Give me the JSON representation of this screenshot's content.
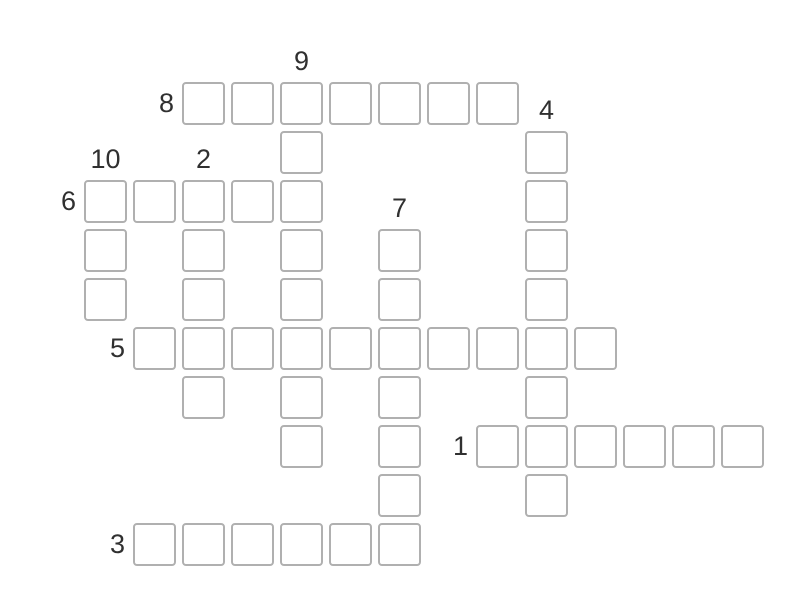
{
  "page": {
    "background_color": "#ffffff",
    "title": "crossword-puzzle"
  },
  "crossword": {
    "grid": {
      "origin_x": 84,
      "origin_y": 82,
      "pitch": 49
    },
    "cell": {
      "size": 43,
      "border_color": "#b0b0b0",
      "border_width": 2,
      "corner_radius": 4,
      "fill_color": "#ffffff"
    },
    "label": {
      "color": "#303030",
      "font_size": 27
    },
    "words": [
      {
        "number": 1,
        "direction": "across",
        "row": 7,
        "col": 8,
        "length": 6
      },
      {
        "number": 2,
        "direction": "down",
        "row": 2,
        "col": 2,
        "length": 5
      },
      {
        "number": 3,
        "direction": "across",
        "row": 9,
        "col": 1,
        "length": 6
      },
      {
        "number": 4,
        "direction": "down",
        "row": 1,
        "col": 9,
        "length": 8
      },
      {
        "number": 5,
        "direction": "across",
        "row": 5,
        "col": 1,
        "length": 10
      },
      {
        "number": 6,
        "direction": "across",
        "row": 2,
        "col": 0,
        "length": 5
      },
      {
        "number": 7,
        "direction": "down",
        "row": 3,
        "col": 6,
        "length": 7
      },
      {
        "number": 8,
        "direction": "across",
        "row": 0,
        "col": 2,
        "length": 7
      },
      {
        "number": 9,
        "direction": "down",
        "row": 0,
        "col": 4,
        "length": 8
      },
      {
        "number": 10,
        "direction": "down",
        "row": 2,
        "col": 0,
        "length": 3
      }
    ]
  }
}
